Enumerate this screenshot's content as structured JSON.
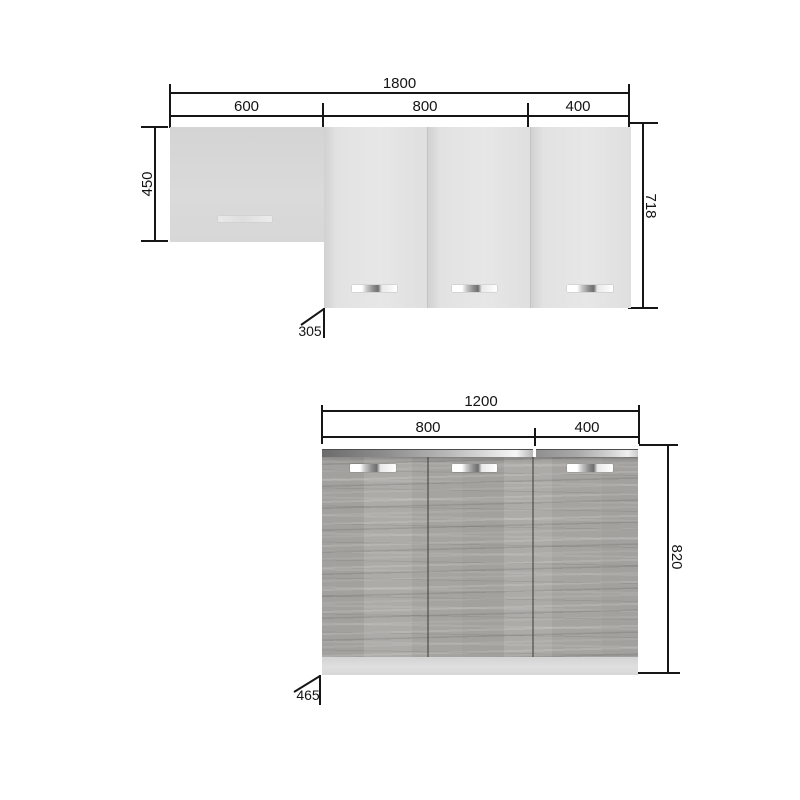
{
  "drawing": {
    "background": "#ffffff",
    "line_color": "#161616"
  },
  "wall_unit": {
    "total_width": "1800",
    "segments": [
      "600",
      "800",
      "400"
    ],
    "left_height": "450",
    "right_height": "718",
    "depth": "305"
  },
  "base_unit": {
    "total_width": "1200",
    "segments": [
      "800",
      "400"
    ],
    "right_height": "820",
    "depth": "465"
  },
  "colors": {
    "wall_cabinet_fill": "#d8d8d8",
    "wall_door_fill": "#e4e4e4",
    "base_wood_fill": "#a9a7a3",
    "plinth_fill": "#dcdcdc",
    "countertop_dark": "#6c6c6c",
    "countertop_light": "#f0f0f0",
    "handle_chrome_dark": "#6e6e6e",
    "handle_chrome_light": "#ffffff",
    "dimension_line": "#161616"
  }
}
